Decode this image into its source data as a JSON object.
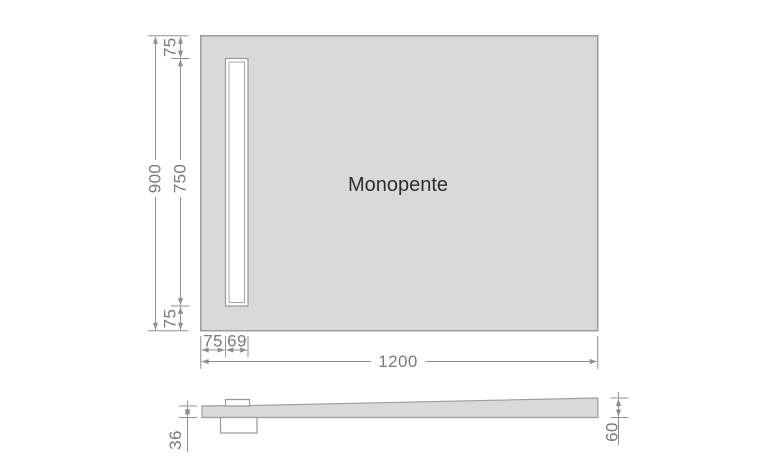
{
  "title": "Monopente",
  "view": "shower-tray-technical-drawing",
  "colors": {
    "background": "#ffffff",
    "tray_fill": "#d9d9d9",
    "tray_stroke": "#9c9c9c",
    "dimension_line": "#8f8f8f",
    "dimension_text": "#7a7a7a",
    "title_text": "#2e2e2e",
    "channel_fill": "#ffffff"
  },
  "dimensions": {
    "overall_width": "1200",
    "overall_depth": "900",
    "channel_length": "750",
    "margin_top": "75",
    "margin_bottom": "75",
    "channel_offset_left": "75",
    "channel_width": "69",
    "profile_height_left": "36",
    "profile_height_right": "60"
  }
}
